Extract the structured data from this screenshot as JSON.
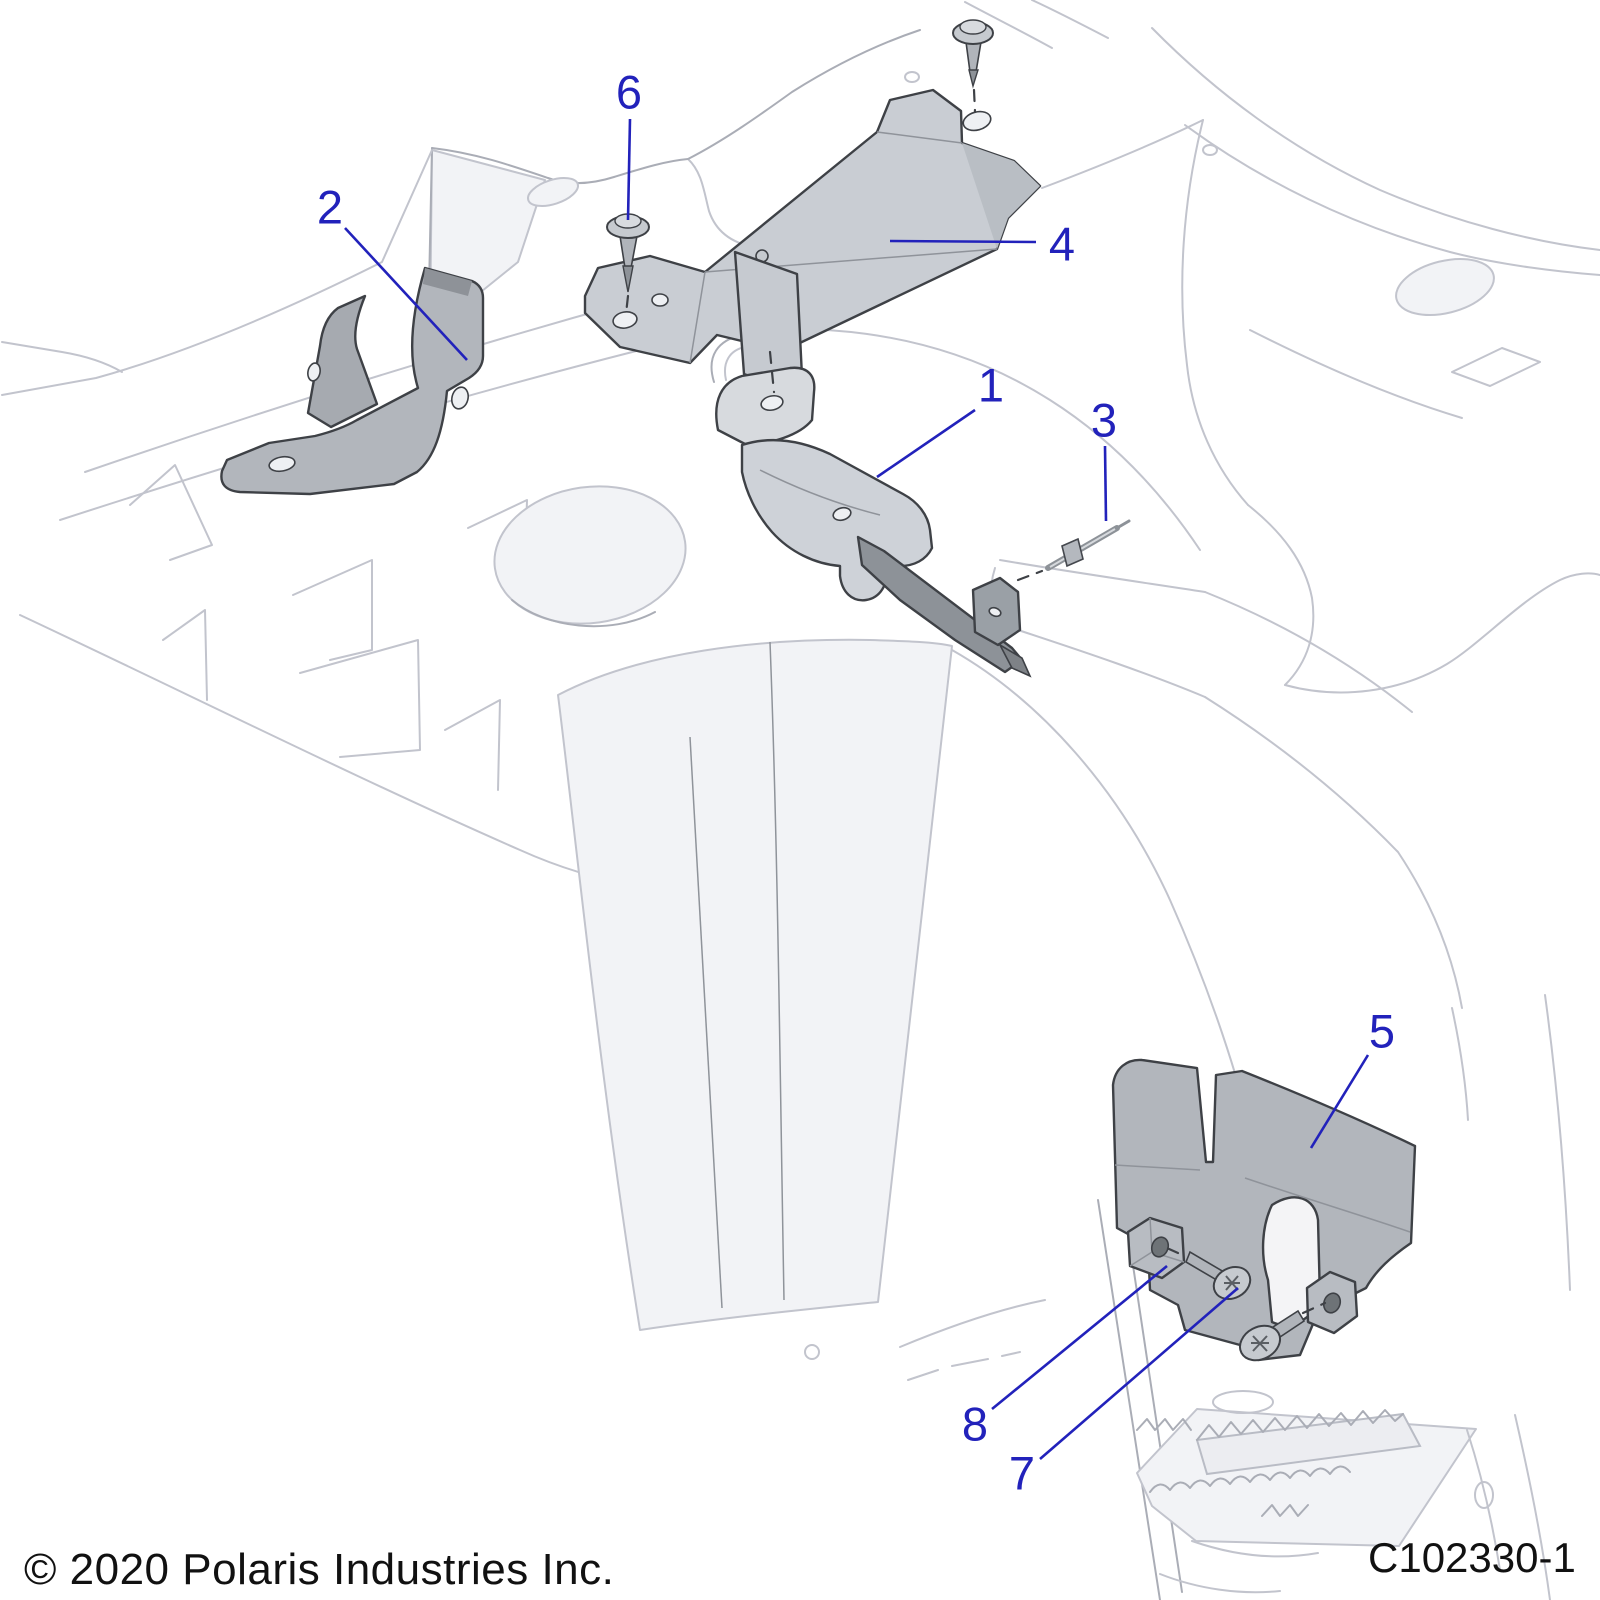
{
  "footer": {
    "copyright": "© 2020 Polaris Industries Inc.",
    "diagram_code": "C102330-1"
  },
  "colors": {
    "callout": "#2222bb",
    "outline_dark": "#3e4146",
    "background_line": "#c2c4cd",
    "part_fill": "#b9bdc3",
    "part_fill_light": "#cdd1d7",
    "part_fill_dark": "#9aa0a6"
  },
  "callout_font_size": 47,
  "callouts": [
    {
      "label": "1",
      "tx": 991,
      "ty": 385,
      "x1": 975,
      "y1": 410,
      "x2": 877,
      "y2": 477
    },
    {
      "label": "2",
      "tx": 330,
      "ty": 207,
      "x1": 345,
      "y1": 228,
      "x2": 467,
      "y2": 360
    },
    {
      "label": "3",
      "tx": 1104,
      "ty": 420,
      "x1": 1105,
      "y1": 446,
      "x2": 1106,
      "y2": 521
    },
    {
      "label": "4",
      "tx": 1062,
      "ty": 244,
      "x1": 1036,
      "y1": 242,
      "x2": 890,
      "y2": 241
    },
    {
      "label": "5",
      "tx": 1382,
      "ty": 1031,
      "x1": 1368,
      "y1": 1055,
      "x2": 1311,
      "y2": 1148
    },
    {
      "label": "6",
      "tx": 629,
      "ty": 92,
      "x1": 630,
      "y1": 119,
      "x2": 628,
      "y2": 220
    },
    {
      "label": "7",
      "tx": 1022,
      "ty": 1473,
      "x1": 1040,
      "y1": 1459,
      "x2": 1238,
      "y2": 1288
    },
    {
      "label": "8",
      "tx": 975,
      "ty": 1424,
      "x1": 992,
      "y1": 1409,
      "x2": 1167,
      "y2": 1266
    }
  ]
}
